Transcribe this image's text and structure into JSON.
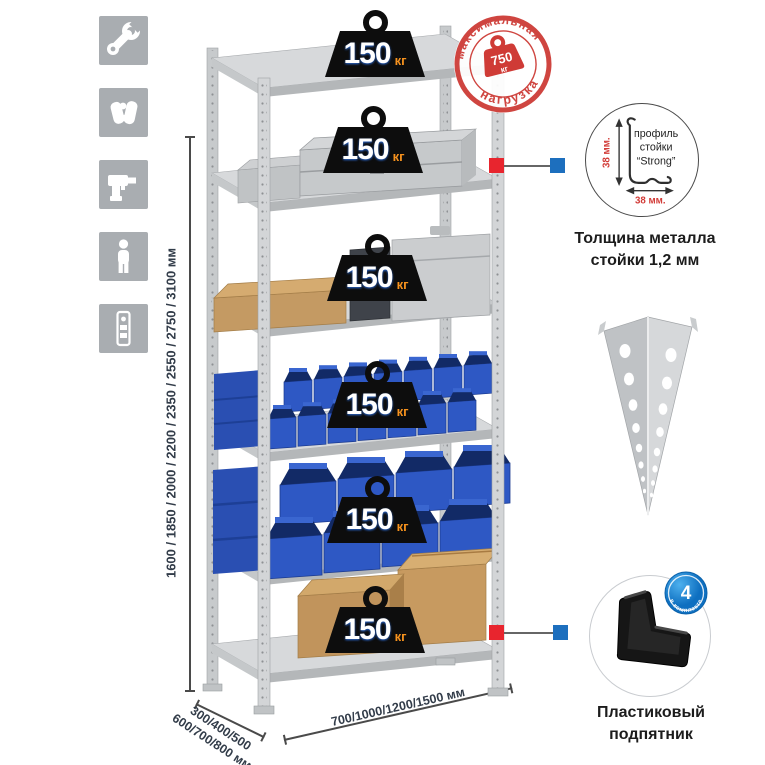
{
  "sidebar": {
    "icons": [
      {
        "name": "wrench-icon"
      },
      {
        "name": "gloves-icon"
      },
      {
        "name": "drill-icon"
      },
      {
        "name": "person-icon"
      },
      {
        "name": "fasteners-icon"
      }
    ]
  },
  "dimensions": {
    "height_options": "1600 / 1850 / 2000 / 2200 / 2350 / 2550 / 2750 / 3100 мм",
    "depth_options_line1": "300/400/500",
    "depth_options_line2": "600/700/800 мм",
    "width_options": "700/1000/1200/1500 мм"
  },
  "shelves": {
    "count": 6,
    "load_per_shelf": "150",
    "load_unit": "кг"
  },
  "max_load_stamp": {
    "arc_top": "максимальная",
    "arc_bottom": "нагрузка",
    "value": "750",
    "unit": "кг"
  },
  "profile_detail": {
    "line1": "профиль",
    "line2": "стойки",
    "line3": "“Strong”",
    "dim_height": "38 мм.",
    "dim_width": "38 мм.",
    "caption_line1": "Толщина металла",
    "caption_line2": "стойки 1,2 мм"
  },
  "foot_detail": {
    "badge_value": "4",
    "badge_arc": "в комплекте",
    "caption_line1": "Пластиковый",
    "caption_line2": "подпятник"
  },
  "colors": {
    "metal_light": "#d3d5d7",
    "metal_mid": "#c7cacc",
    "metal_dark": "#b4b7b9",
    "bin_blue": "#2e58c4",
    "bin_blue_dark": "#122a66",
    "cardboard": "#c79a60",
    "stamp_red": "#cf4540",
    "callout_red": "#e8252e",
    "callout_blue": "#1d6fbe",
    "badge_blue": "#1b86d0",
    "weight_unit_orange": "#f6921e",
    "dimension_text": "#323c49"
  }
}
